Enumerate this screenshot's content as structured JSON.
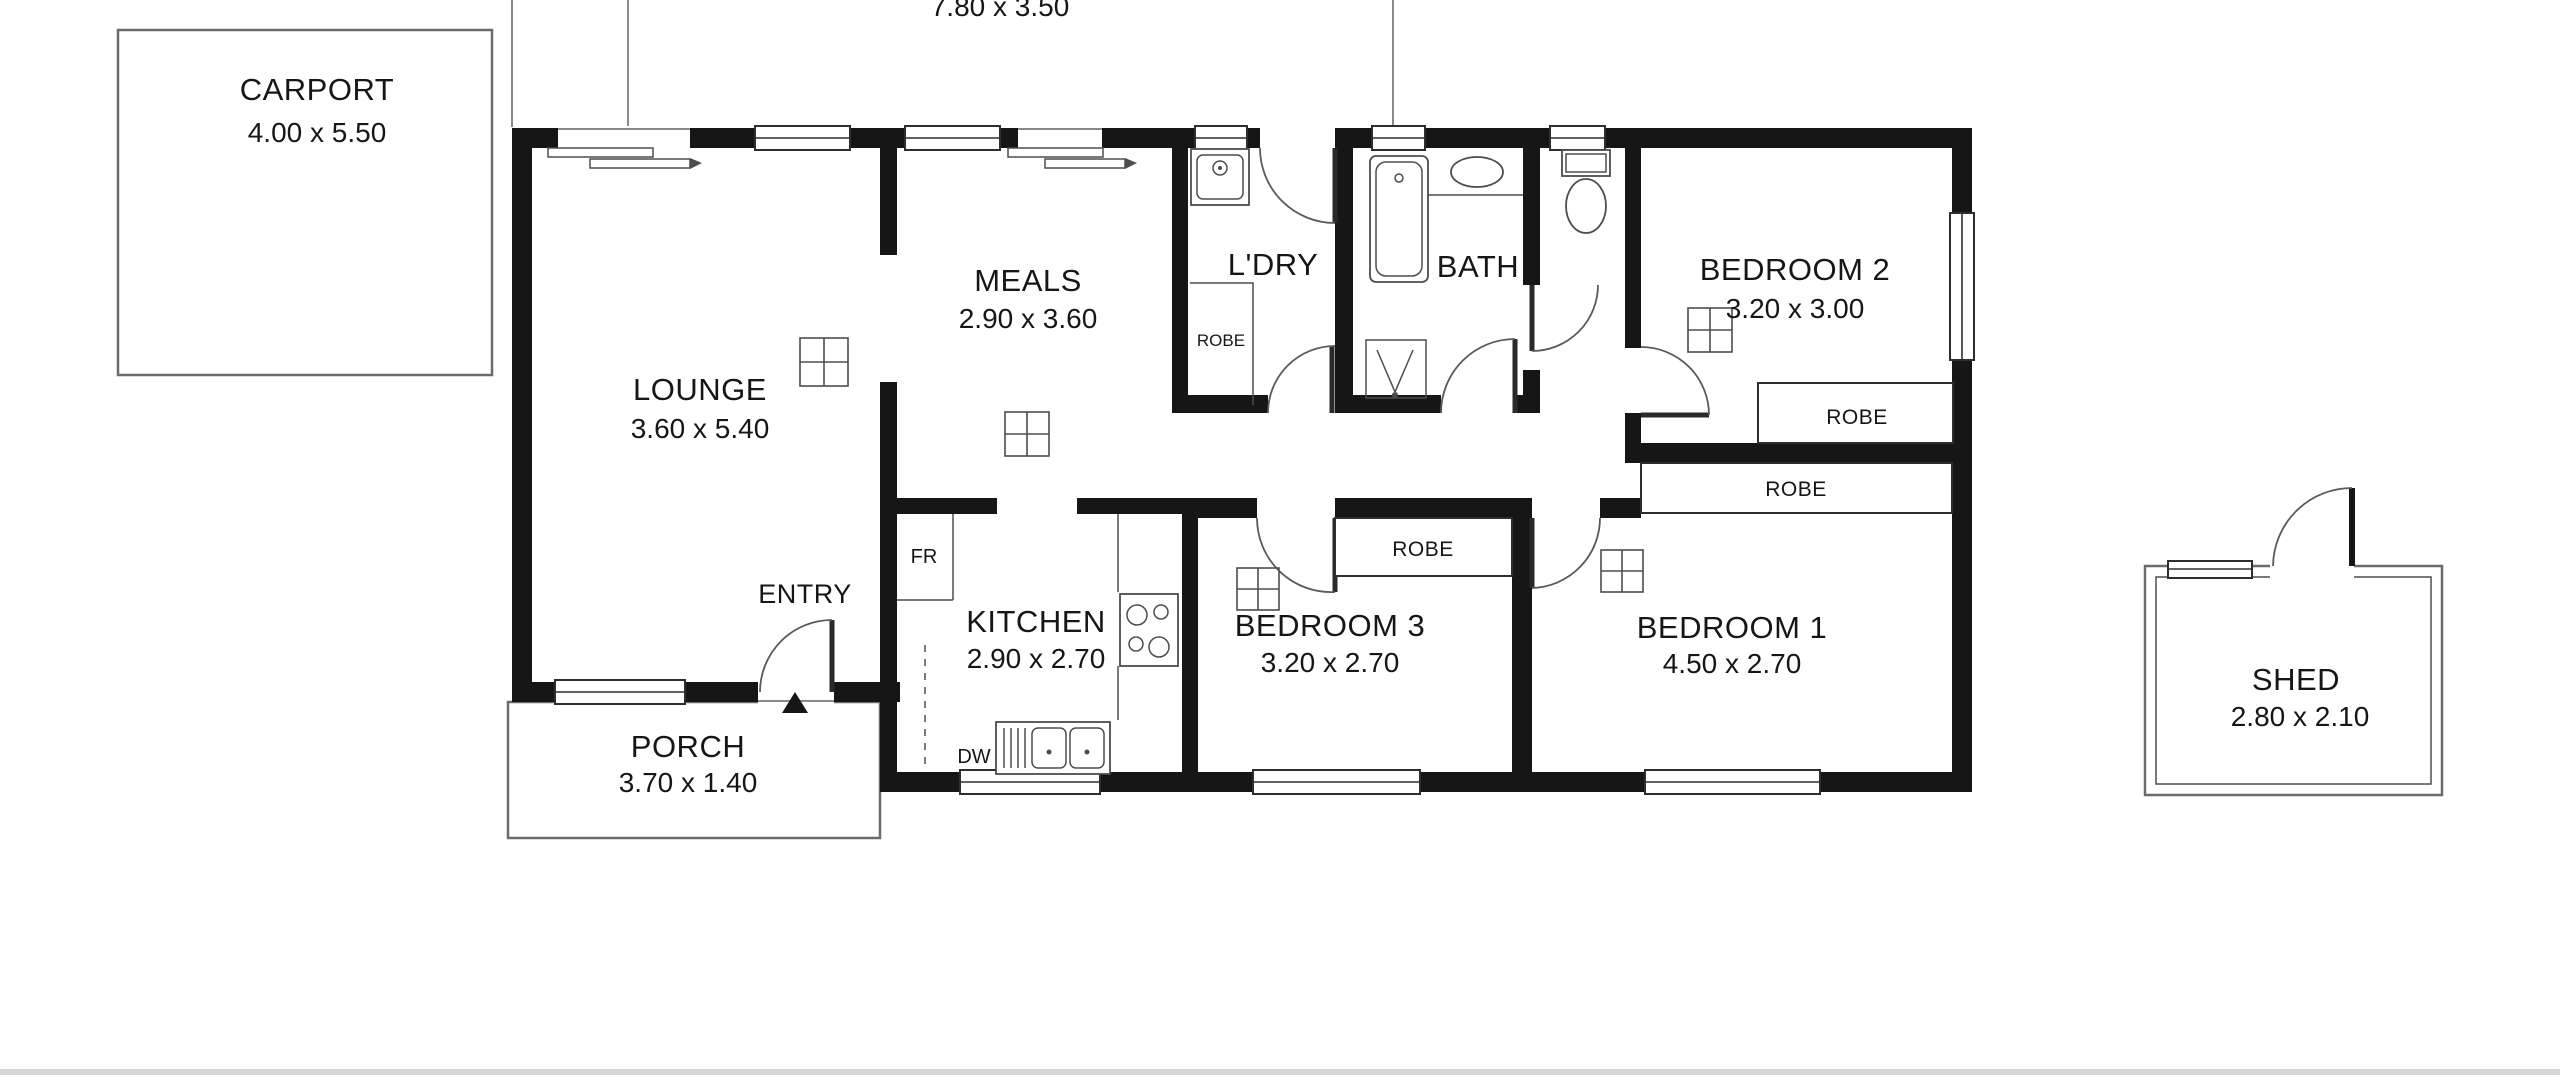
{
  "palette": {
    "wall": "#161616",
    "fixture_line": "#4d4d4d",
    "outline_gray": "#6b6b6b",
    "page_edge": "#d6d6d6",
    "background": "#ffffff"
  },
  "verandah": {
    "dims": "7.80 x 3.50"
  },
  "carport": {
    "name": "CARPORT",
    "dims": "4.00 x 5.50"
  },
  "lounge": {
    "name": "LOUNGE",
    "dims": "3.60 x 5.40"
  },
  "meals": {
    "name": "MEALS",
    "dims": "2.90 x 3.60"
  },
  "laundry": {
    "name": "L'DRY",
    "robe_label": "ROBE"
  },
  "bath": {
    "name": "BATH"
  },
  "bedroom2": {
    "name": "BEDROOM 2",
    "dims": "3.20 x 3.00",
    "robe_label": "ROBE"
  },
  "bedroom3": {
    "name": "BEDROOM 3",
    "dims": "3.20 x 2.70",
    "robe_label": "ROBE"
  },
  "bedroom1": {
    "name": "BEDROOM 1",
    "dims": "4.50 x 2.70",
    "robe_label": "ROBE"
  },
  "kitchen": {
    "name": "KITCHEN",
    "dims": "2.90 x 2.70",
    "fridge_label": "FR",
    "dishwasher_label": "DW"
  },
  "entry": {
    "label": "ENTRY"
  },
  "porch": {
    "name": "PORCH",
    "dims": "3.70 x 1.40"
  },
  "shed": {
    "name": "SHED",
    "dims": "2.80 x 2.10"
  }
}
